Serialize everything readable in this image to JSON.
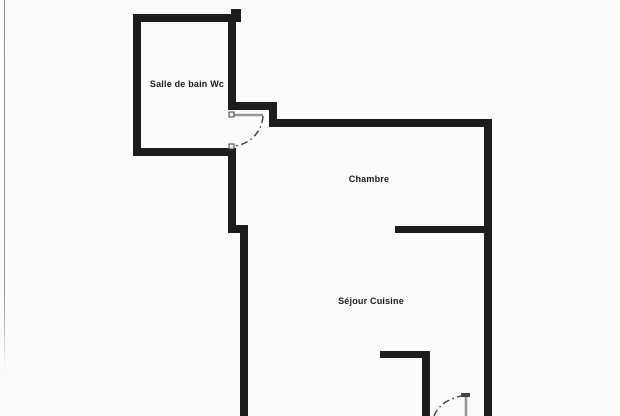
{
  "document": {
    "kind": "scanned floor plan"
  },
  "colors": {
    "background": "#fbfbfa",
    "wall": "#1d1d1d",
    "door_leaf": "#979797",
    "door_marker_fill": "#f0f0f0",
    "door_marker_stroke": "#444444",
    "door_swing": "#3a3a3a",
    "page_edge": "#909090",
    "label_text": "#1a1a1a"
  },
  "plan": {
    "rooms": [
      {
        "id": "salle-de-bain-wc",
        "label": "Salle de bain Wc"
      },
      {
        "id": "chambre",
        "label": "Chambre"
      },
      {
        "id": "sejour-cuisine",
        "label": "Séjour Cuisine"
      }
    ],
    "doors": [
      {
        "id": "bathroom-door",
        "style": "dash-dot swing arc, leaf open"
      },
      {
        "id": "entry-door",
        "style": "dash-dot swing arc, leaf open, partially cropped at bottom"
      }
    ]
  }
}
